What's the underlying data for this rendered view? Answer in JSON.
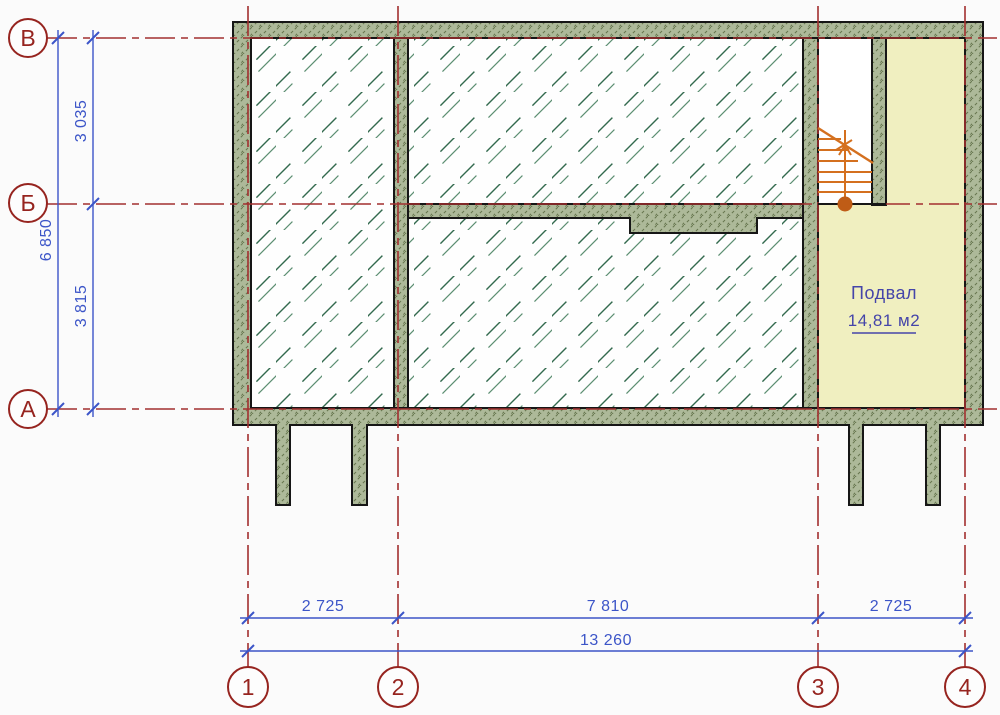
{
  "room": {
    "name": "Подвал",
    "area": "14,81 м2"
  },
  "axis_rows": [
    {
      "label": "В"
    },
    {
      "label": "Б"
    },
    {
      "label": "А"
    }
  ],
  "axis_cols": [
    {
      "label": "1"
    },
    {
      "label": "2"
    },
    {
      "label": "3"
    },
    {
      "label": "4"
    }
  ],
  "dims_left": {
    "total": "6 850",
    "segments": [
      "3 035",
      "3 815"
    ]
  },
  "dims_bottom": {
    "total": "13 260",
    "segments": [
      "2 725",
      "7 810",
      "2 725"
    ]
  },
  "colors": {
    "axis_red": "#a22f2f",
    "axis_bubble_red": "#96241f",
    "dimension_blue": "#3c55c8",
    "wall_fill": "#adb999",
    "wall_hatch": "#66754e",
    "room_hatch_green": "#336a4e",
    "basement_fill": "#f0efc0",
    "stair_orange": "#d4701f",
    "room_label_blue": "#4545a9",
    "background": "#fbfbfb"
  }
}
